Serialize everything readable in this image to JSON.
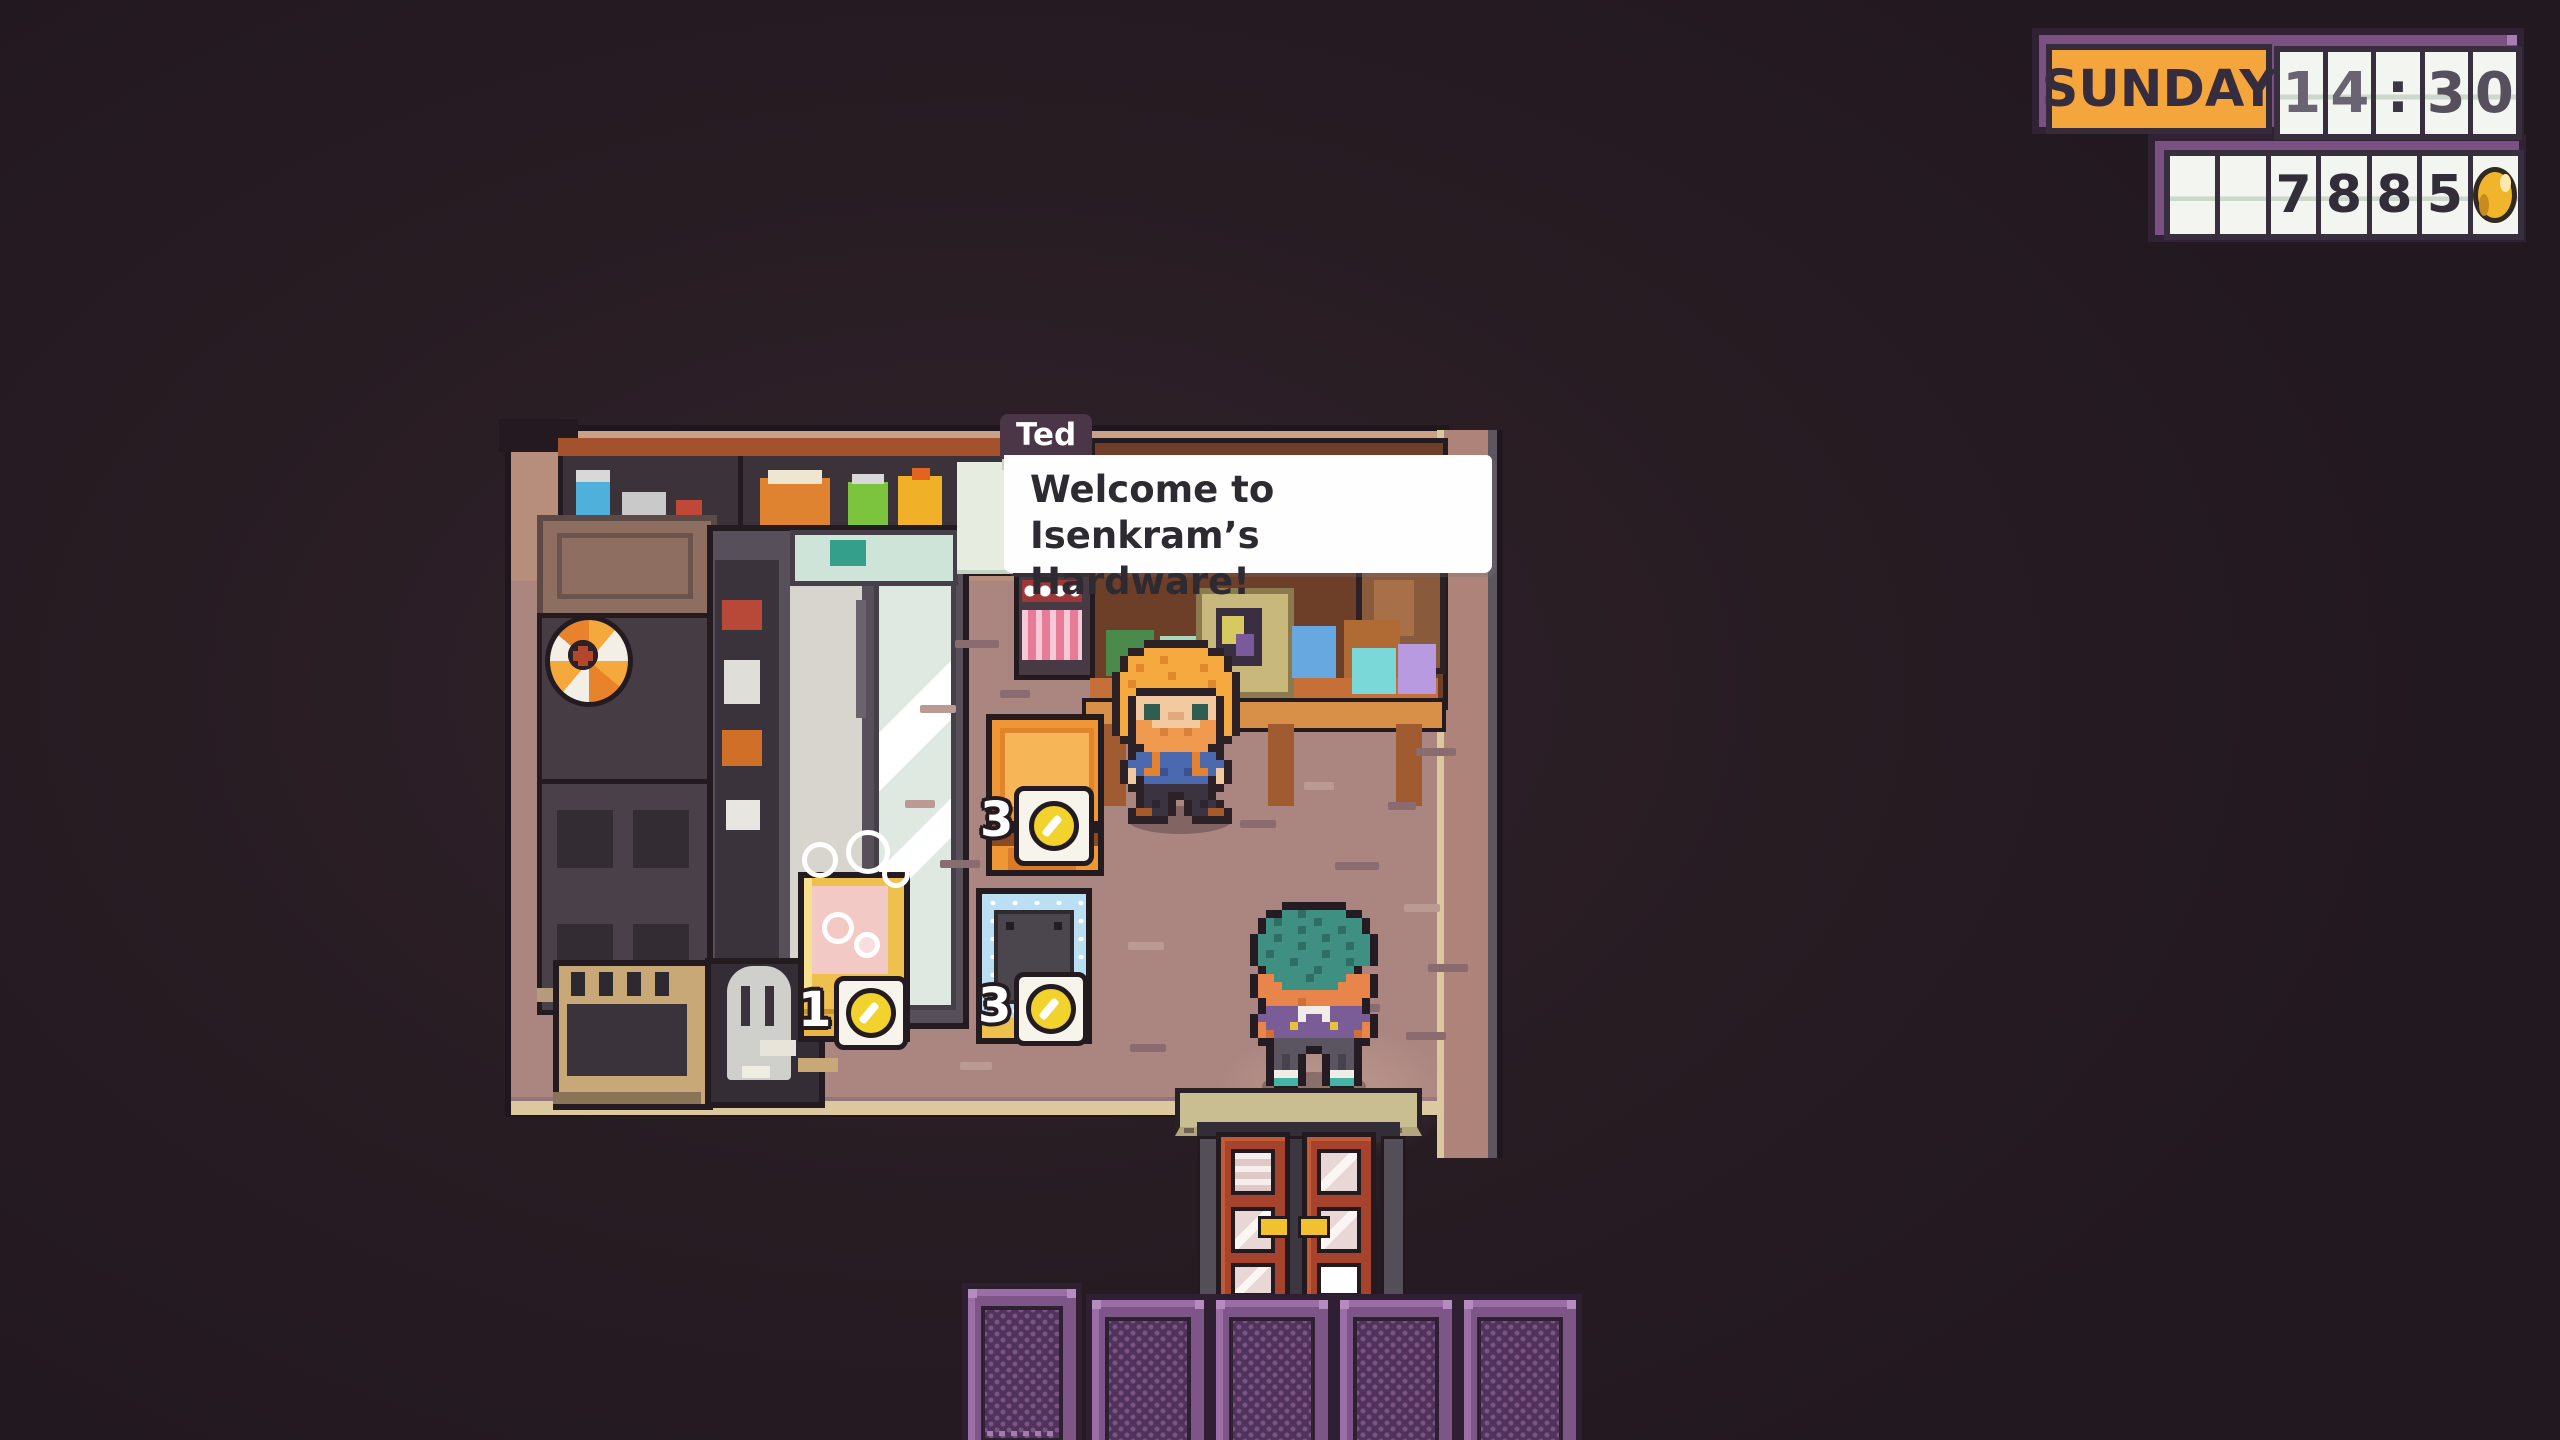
{
  "hud": {
    "day": "SUNDAY",
    "time": "14:30",
    "time_cells": [
      "1",
      "4",
      ":",
      "3",
      "0"
    ],
    "money": "7885",
    "money_cells": [
      "",
      "",
      "7",
      "8",
      "8",
      "5"
    ],
    "coin_icon": "gold-coin",
    "colors": {
      "frame_purple": "#7b5184",
      "frame_outline": "#302134",
      "day_orange": "#f4a53c",
      "cell_white": "#f3f5f0",
      "coin_gold": "#f0b52a"
    }
  },
  "dialogue": {
    "speaker": "Ted",
    "text": "Welcome to Isenkram’s Hardware!",
    "lines": [
      "Welcome to Isenkram’s",
      "Hardware!"
    ]
  },
  "shop": {
    "name": "Isenkram’s Hardware",
    "items": [
      {
        "name": "orange-crate",
        "price": "3",
        "price_icon": "coin"
      },
      {
        "name": "bathtub",
        "price": "1",
        "price_icon": "coin"
      },
      {
        "name": "blue-machine",
        "price": "3",
        "price_icon": "coin"
      }
    ]
  }
}
